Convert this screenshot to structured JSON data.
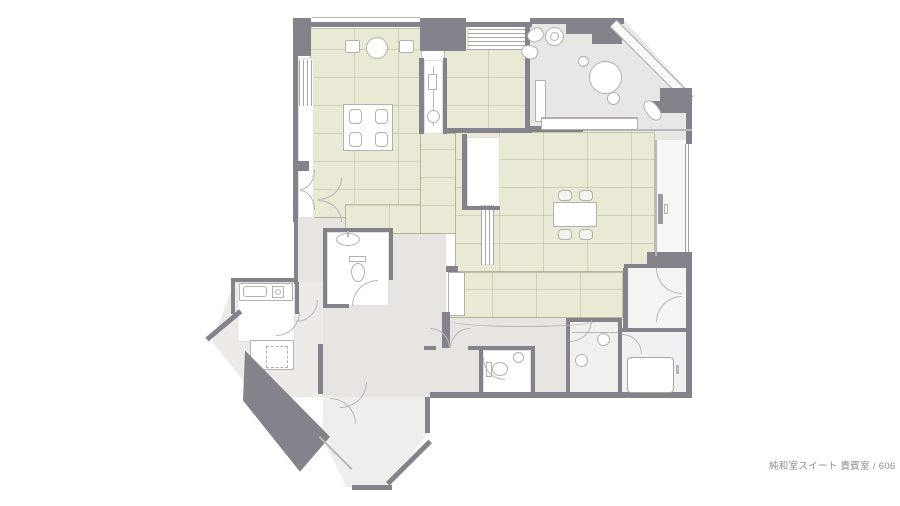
{
  "caption": {
    "text": "純和室スイート 貴賓室 / 606"
  },
  "colors": {
    "wall": "#84838b",
    "tatami": "#e9e9d5",
    "corridor": "#e8e4e1",
    "living": "#e9e7e5",
    "entry": "#edeae8",
    "bath": "#eff1f2",
    "line": "#b7b6bc",
    "caption_text": "#8d8d8d"
  }
}
